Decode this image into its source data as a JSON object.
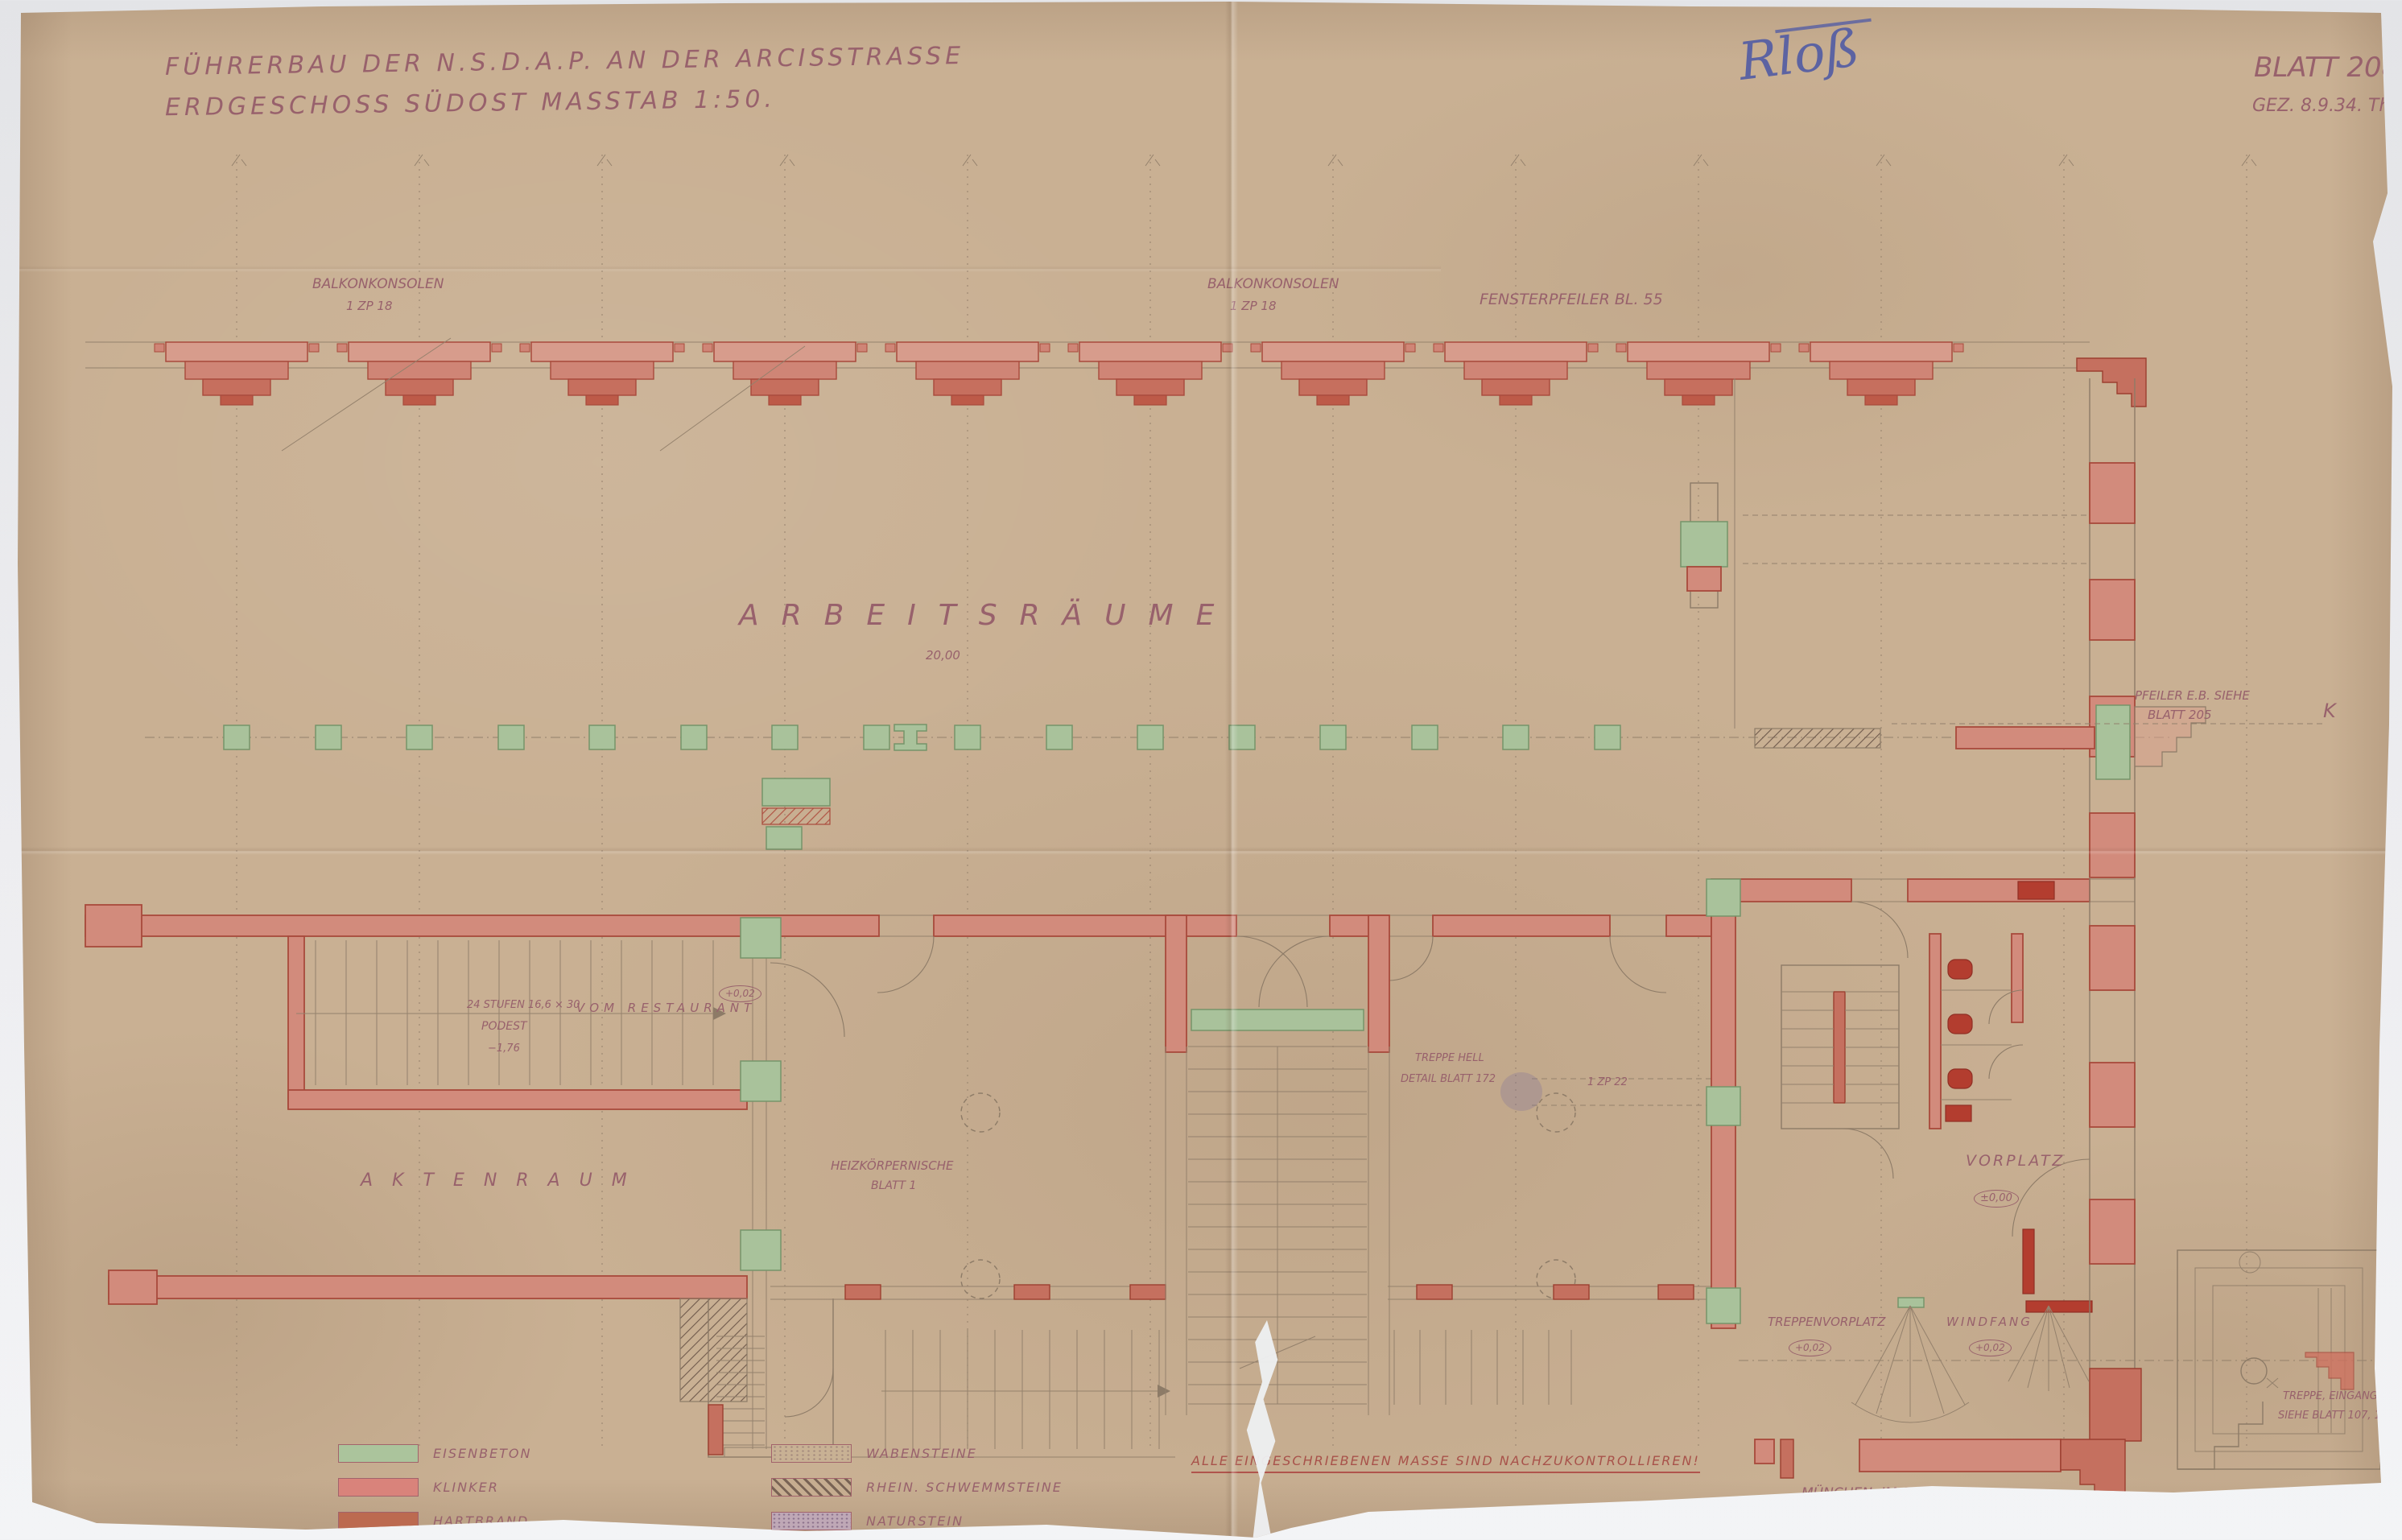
{
  "document": {
    "title_line1": "FÜHRERBAU DER N.S.D.A.P. AN DER ARCISSTRASSE",
    "title_line2": "ERDGESCHOSS SÜDOST MASSTAB 1:50.",
    "sheet_no": "BLATT 208.",
    "drawn": "GEZ. 8.9.34. Th.",
    "signature": "Rloß"
  },
  "annotations": {
    "balkonkonsolen": "BALKONKONSOLEN",
    "balkon_ref": "1 ZP 18",
    "fensterpfeiler": "FENSTERPFEILER BL. 55",
    "arbeitsraeume": "ARBEITSRÄUME",
    "dim_20": "20,00",
    "pfeiler_line1": "PFEILER E.B. SIEHE",
    "pfeiler_line2": "BLATT 205",
    "k_mark": "K",
    "aktenraum": "AKTENRAUM",
    "stufen": "24 STUFEN 16,6 × 30",
    "vom_restaurant": "VOM RESTAURANT",
    "podest": "PODEST",
    "minus_176": "−1,76",
    "plus_002": "+0,02",
    "heiz_line1": "HEIZKÖRPERNISCHE",
    "heiz_line2": "BLATT 1",
    "treppe_hell": "TREPPE HELL",
    "detail_blatt": "DETAIL BLATT 172",
    "zp22": "1 ZP 22",
    "vorplatz": "VORPLATZ",
    "pm_000": "±0,00",
    "treppenvorplatz": "TREPPENVORPLATZ",
    "windfang": "WINDFANG",
    "treppe_eingang": "TREPPE, EINGANG",
    "siehe_blatt": "SIEHE BLATT 107, 108, 109"
  },
  "legend": {
    "items": [
      {
        "name": "eisenbeton",
        "label": "EISENBETON",
        "color": "#abc49c"
      },
      {
        "name": "klinker",
        "label": "KLINKER",
        "color": "#d9837b"
      },
      {
        "name": "hartbrand",
        "label": "HARTBRAND",
        "color": "#bc6a50"
      },
      {
        "name": "wabensteine",
        "label": "WABENSTEINE",
        "color": "#c8b194"
      },
      {
        "name": "rhein-schwemmsteine",
        "label": "RHEIN. SCHWEMMSTEINE",
        "color": "#8a7465"
      },
      {
        "name": "naturstein",
        "label": "NATURSTEIN",
        "color": "#b49bb4"
      }
    ]
  },
  "footer": {
    "note": "ALLE EINGESCHRIEBENEN MASSE SIND NACHZUKONTROLLIEREN!",
    "place_date": "MÜNCHEN, IM SEPT. 1934."
  },
  "colors": {
    "paper": "#c9b093",
    "wall_red": "#d28b7c",
    "wall_dark_red": "#b33d2f",
    "concrete_green": "#a9c29b",
    "ink_violet": "#98616c",
    "ink_blue": "#5c63a2"
  }
}
